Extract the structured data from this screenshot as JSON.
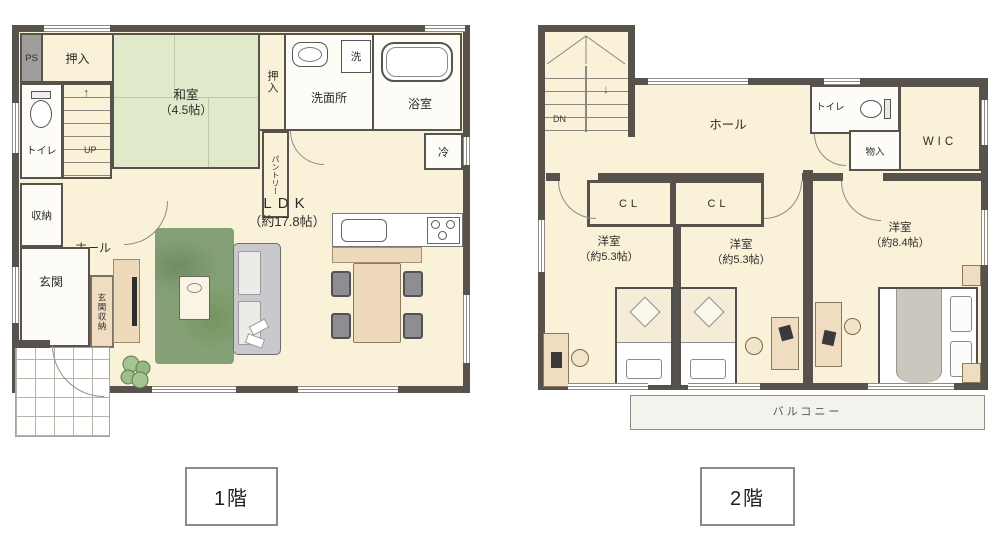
{
  "colors": {
    "wall": "#57524c",
    "floor": "#f9f2d8",
    "roomwhite": "#fdfcf6",
    "tatami": "#e0e9c9",
    "rug": "#85a076",
    "wood": "#eed9ba",
    "balcony": "#f3f2ed",
    "graybox": "#a09e9c"
  },
  "floor1": {
    "label": "1階",
    "ps": "PS",
    "oshiire_top": "押入",
    "washitsu_name": "和室",
    "washitsu_size": "（4.5帖）",
    "oshiire_side": "押入",
    "senmenjo": "洗面所",
    "washer": "洗",
    "bath": "浴室",
    "toilet": "トイレ",
    "up": "UP",
    "storage": "収納",
    "hall": "ホール",
    "genkan": "玄関",
    "genkan_storage": "玄関収納",
    "pantry": "パントリー",
    "ldk_name": "LDK",
    "ldk_size": "（約17.8帖）",
    "fridge": "冷"
  },
  "floor2": {
    "label": "2階",
    "dn": "DN",
    "hall": "ホール",
    "toilet": "トイレ",
    "wic": "WIC",
    "storage": "物入",
    "cl1": "CL",
    "cl2": "CL",
    "bedroom1_name": "洋室",
    "bedroom1_size": "（約5.3帖）",
    "bedroom2_name": "洋室",
    "bedroom2_size": "（約5.3帖）",
    "bedroom3_name": "洋室",
    "bedroom3_size": "（約8.4帖）",
    "balcony": "バルコニー"
  }
}
